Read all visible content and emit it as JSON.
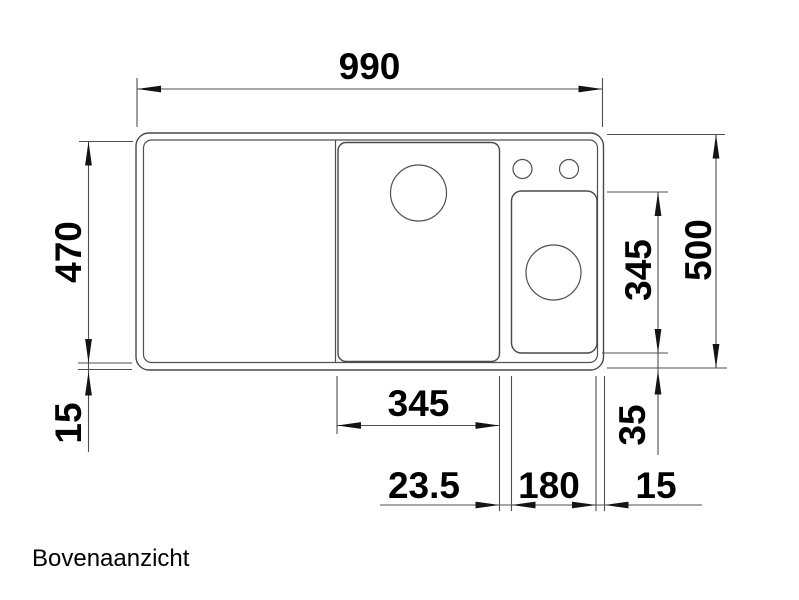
{
  "caption": "Bovenaanzicht",
  "dimensions": {
    "overall_width_mm": "990",
    "inner_depth_mm": "470",
    "overall_depth_mm": "500",
    "left_bottom_rim_mm": "15",
    "small_bowl_depth_mm": "345",
    "small_bowl_bottom_offset_mm": "35",
    "main_bowl_width_mm": "345",
    "bowl_gap_mm": "23.5",
    "small_bowl_width_mm": "180",
    "right_rim_mm": "15"
  }
}
